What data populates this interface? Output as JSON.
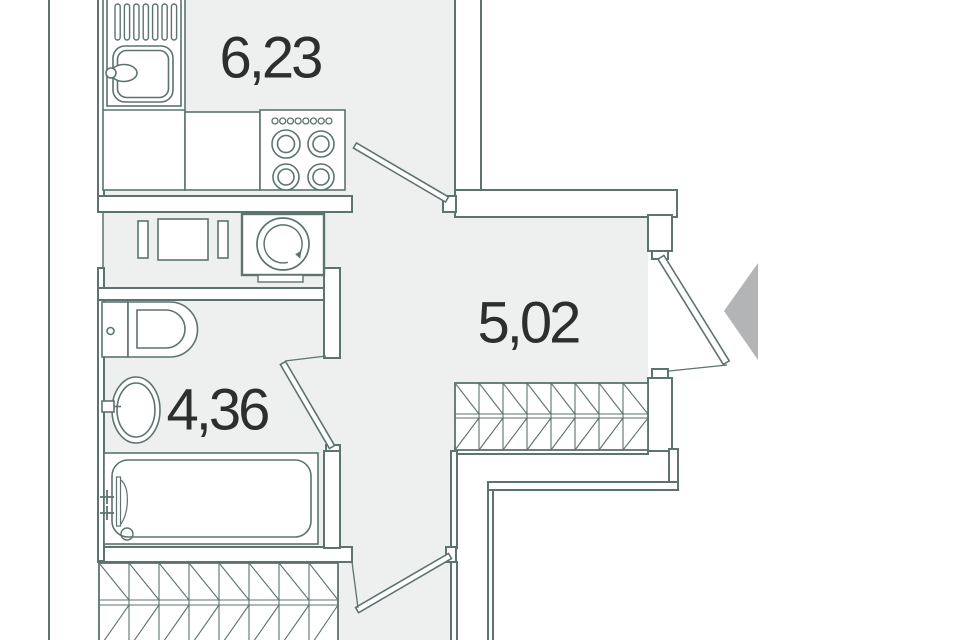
{
  "floor_plan": {
    "rooms": {
      "kitchen": {
        "name": "kitchen",
        "area_label": "6,23"
      },
      "hallway": {
        "name": "hallway",
        "area_label": "5,02"
      },
      "bathroom": {
        "name": "bathroom",
        "area_label": "4,36"
      }
    },
    "fixtures": [
      "kitchen-sink-unit",
      "kitchen-counter",
      "stove-4-burner",
      "niche-shelf",
      "washing-machine",
      "toilet",
      "washbasin",
      "bathtub",
      "hallway-wardrobe",
      "living-room-wardrobe"
    ],
    "doors": [
      "kitchen-door",
      "bathroom-door",
      "living-room-door",
      "entrance-door"
    ],
    "entrance_marker": "entrance-arrow",
    "colors": {
      "wall_line": "#5c736f",
      "floor_fill": "#eef0ef",
      "wall_fill": "#ffffff",
      "entrance_arrow": "#b2b4b5",
      "label_text": "#2e2e2e"
    }
  }
}
